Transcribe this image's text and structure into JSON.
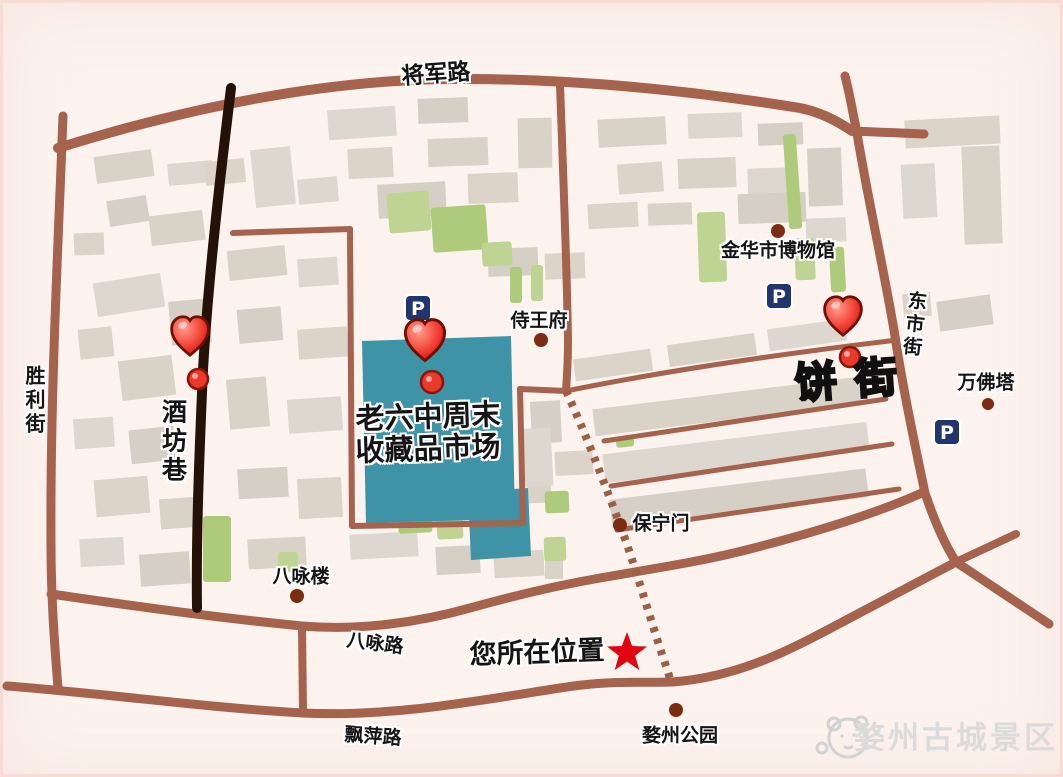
{
  "map": {
    "colors": {
      "background": "#fcf3ef",
      "road": "#a5624c",
      "road_dark": "#241208",
      "dashed_road": "#9c5f45",
      "market_teal": "#3e93a6",
      "building_shades": [
        "#d9d2c6",
        "#ddd8cf",
        "#d5cfc5",
        "#dcd4c8"
      ],
      "green_shades": [
        "#aecb7c",
        "#bdd492"
      ],
      "parking_blue": "#21356f",
      "heart_red": "#e8392b",
      "star_red": "#e00611",
      "landmark_dot": "#7c2c12",
      "text": "#141414",
      "watermark_gray": "#dbdbdb"
    },
    "labels": {
      "jiangjun_road": {
        "text": "将军路",
        "x": 436,
        "y": 75,
        "size": 23,
        "rot": -4,
        "style": "halo"
      },
      "shengli_street": {
        "text": "胜利街",
        "x": 34,
        "y": 401,
        "size": 20,
        "dir": "v",
        "style": "halo"
      },
      "jiufang_lane": {
        "text": "酒坊巷",
        "x": 173,
        "y": 442,
        "size": 25,
        "dir": "v",
        "style": "halo"
      },
      "shiwang_fu": {
        "text": "侍王府",
        "x": 539,
        "y": 321,
        "size": 19,
        "style": "halo"
      },
      "jinhua_museum": {
        "text": "金华市博物馆",
        "x": 778,
        "y": 251,
        "size": 19,
        "style": "halo"
      },
      "dongshi_street": {
        "text": "东市街",
        "x": 913,
        "y": 325,
        "size": 19,
        "dir": "v",
        "rot": 6,
        "style": "halo"
      },
      "wanfo_tower": {
        "text": "万佛塔",
        "x": 986,
        "y": 383,
        "size": 19,
        "style": "halo"
      },
      "bing_street": {
        "text": "饼街",
        "x": 855,
        "y": 380,
        "size": 42,
        "rot": -4,
        "style": "outline",
        "ls": 18
      },
      "baoning_gate": {
        "text": "保宁门",
        "x": 661,
        "y": 524,
        "size": 19,
        "style": "halo"
      },
      "bayong_tower": {
        "text": "八咏楼",
        "x": 301,
        "y": 577,
        "size": 19,
        "style": "halo"
      },
      "bayong_road": {
        "text": "八咏路",
        "x": 375,
        "y": 644,
        "size": 19,
        "rot": 7,
        "style": "halo"
      },
      "piaoping_road": {
        "text": "飘萍路",
        "x": 373,
        "y": 737,
        "size": 19,
        "rot": 4,
        "style": "halo"
      },
      "your_location": {
        "text": "您所在位置",
        "x": 537,
        "y": 653,
        "size": 27,
        "rot": -2,
        "style": "halo"
      },
      "market_line1": {
        "text": "老六中周末",
        "x": 428,
        "y": 417,
        "size": 29,
        "rot": -2,
        "style": "halo"
      },
      "market_line2": {
        "text": "收藏品市场",
        "x": 428,
        "y": 449,
        "size": 29,
        "rot": -2,
        "style": "halo"
      },
      "wuzhou_park": {
        "text": "婺州公园",
        "x": 680,
        "y": 736,
        "size": 19,
        "style": "halo"
      },
      "watermark": {
        "text": "婺州古城景区",
        "x": 956,
        "y": 739,
        "size": 31,
        "style": "watermark"
      }
    },
    "parking_label": "P",
    "roads": [
      {
        "id": "jiangjun-road",
        "d": "M 58,148 C 200,104 330,80 450,79 C 580,78 700,92 800,108 C 820,112 836,120 852,131",
        "w": 10
      },
      {
        "id": "jiangjun-road-stub",
        "d": "M 852,131 L 924,134",
        "w": 9
      },
      {
        "id": "dongshi-street",
        "d": "M 845,76 C 850,95 853,114 857,133 C 868,200 882,260 894,330 C 903,390 916,450 925,493 C 934,520 944,543 956,562",
        "w": 9
      },
      {
        "id": "southeast-branch",
        "d": "M 956,562 L 1049,624",
        "w": 9
      },
      {
        "id": "northeast-branch",
        "d": "M 956,562 C 975,553 995,544 1016,534",
        "w": 8
      },
      {
        "id": "shengli-street",
        "d": "M 63,116 C 58,250 50,400 51,545 C 51,600 55,650 58,688",
        "w": 9
      },
      {
        "id": "bayong-road",
        "d": "M 51,594 C 140,607 220,618 302,626 C 360,631 420,622 470,608 C 520,594 560,585 600,578 C 650,569 700,562 750,549 C 820,531 880,512 924,492",
        "w": 9
      },
      {
        "id": "piaoping-road",
        "d": "M 7,686 C 110,694 210,708 303,713 C 390,717 470,702 560,688 C 610,680 640,683 672,682 C 740,677 790,650 850,618 C 890,597 925,578 956,562",
        "w": 9
      },
      {
        "id": "cross-connector",
        "d": "M 302,626 L 303,713",
        "w": 8
      },
      {
        "id": "mid-vertical-road",
        "d": "M 560,84 C 563,170 567,270 568,340 C 568,360 567,377 566,391",
        "w": 8
      }
    ],
    "thin_roads": [
      {
        "id": "block-street-1",
        "d": "M 566,391 C 660,372 780,354 897,340",
        "w": 5
      },
      {
        "id": "block-street-2",
        "d": "M 604,441 L 886,399",
        "w": 5
      },
      {
        "id": "block-street-3",
        "d": "M 611,486 L 892,444",
        "w": 5
      },
      {
        "id": "block-street-4",
        "d": "M 617,530 L 899,489",
        "w": 5
      },
      {
        "id": "market-outline-top",
        "d": "M 233,233 L 350,229",
        "w": 6
      },
      {
        "id": "market-outline-left",
        "d": "M 350,229 L 352,526",
        "w": 6
      },
      {
        "id": "market-outline-bottom",
        "d": "M 352,526 L 523,523",
        "w": 6
      },
      {
        "id": "market-outline-right",
        "d": "M 523,523 L 520,389",
        "w": 6
      },
      {
        "id": "market-outline-link",
        "d": "M 520,389 L 566,391",
        "w": 6
      }
    ],
    "black_road": {
      "id": "jiufang-lane-road",
      "d": "M 231,88 C 221,170 208,280 203,370 C 199,460 196,540 197,608",
      "w": 10
    },
    "dashed_road": {
      "id": "pedestrian-street",
      "d": "M 566,391 C 585,432 602,477 620,525 C 634,562 652,625 664,660 C 668,672 670,678 671,684",
      "w": 8,
      "dash": "5 7"
    },
    "teal_blocks": [
      {
        "points": "362,341 511,336 515,519 366,523"
      },
      {
        "points": "468,492 528,488 531,556 471,560"
      }
    ],
    "greens": [
      [
        203,
        516,
        28,
        66,
        0
      ],
      [
        388,
        192,
        42,
        40,
        -5
      ],
      [
        432,
        206,
        55,
        45,
        -4
      ],
      [
        482,
        242,
        30,
        24,
        -3
      ],
      [
        398,
        509,
        34,
        24,
        -3
      ],
      [
        437,
        519,
        26,
        20,
        -3
      ],
      [
        545,
        491,
        24,
        22,
        -2
      ],
      [
        544,
        537,
        22,
        24,
        -2
      ],
      [
        616,
        437,
        18,
        10,
        -6
      ],
      [
        698,
        212,
        28,
        70,
        -2
      ],
      [
        786,
        134,
        13,
        95,
        -4
      ],
      [
        795,
        238,
        20,
        42,
        -2
      ],
      [
        830,
        247,
        15,
        45,
        -3
      ],
      [
        278,
        552,
        20,
        20,
        0
      ],
      [
        510,
        267,
        12,
        36,
        0
      ],
      [
        531,
        265,
        12,
        36,
        0
      ]
    ],
    "buildings": [
      [
        95,
        153,
        58,
        27,
        -8
      ],
      [
        168,
        162,
        45,
        22,
        -5
      ],
      [
        108,
        198,
        40,
        26,
        -9
      ],
      [
        74,
        233,
        30,
        22,
        -2
      ],
      [
        150,
        213,
        54,
        30,
        -7
      ],
      [
        95,
        278,
        68,
        34,
        -9
      ],
      [
        170,
        300,
        40,
        44,
        -5
      ],
      [
        79,
        328,
        34,
        30,
        -6
      ],
      [
        120,
        358,
        54,
        40,
        -7
      ],
      [
        74,
        418,
        40,
        30,
        -4
      ],
      [
        130,
        428,
        45,
        34,
        -6
      ],
      [
        95,
        478,
        54,
        37,
        -5
      ],
      [
        160,
        498,
        40,
        30,
        -4
      ],
      [
        80,
        538,
        44,
        28,
        -3
      ],
      [
        140,
        553,
        50,
        32,
        -4
      ],
      [
        205,
        160,
        40,
        24,
        -6
      ],
      [
        228,
        248,
        58,
        30,
        -6
      ],
      [
        298,
        258,
        40,
        28,
        -4
      ],
      [
        238,
        308,
        44,
        34,
        -5
      ],
      [
        298,
        328,
        50,
        30,
        -4
      ],
      [
        228,
        378,
        40,
        50,
        -5
      ],
      [
        288,
        398,
        54,
        34,
        -4
      ],
      [
        238,
        468,
        50,
        30,
        -3
      ],
      [
        298,
        478,
        44,
        40,
        -3
      ],
      [
        248,
        538,
        58,
        30,
        -3
      ],
      [
        328,
        108,
        68,
        30,
        -4
      ],
      [
        418,
        98,
        50,
        25,
        -2
      ],
      [
        348,
        148,
        45,
        30,
        -3
      ],
      [
        428,
        138,
        60,
        28,
        -2
      ],
      [
        298,
        178,
        40,
        25,
        -5
      ],
      [
        378,
        183,
        68,
        34,
        -3
      ],
      [
        468,
        173,
        50,
        30,
        -2
      ],
      [
        518,
        118,
        34,
        50,
        -1
      ],
      [
        253,
        148,
        40,
        58,
        -6
      ],
      [
        488,
        248,
        50,
        28,
        -2
      ],
      [
        545,
        253,
        40,
        26,
        -2
      ],
      [
        598,
        118,
        68,
        28,
        -3
      ],
      [
        688,
        113,
        54,
        25,
        -2
      ],
      [
        758,
        123,
        45,
        22,
        -2
      ],
      [
        618,
        163,
        45,
        30,
        -4
      ],
      [
        678,
        158,
        58,
        30,
        -2
      ],
      [
        748,
        168,
        40,
        44,
        -2
      ],
      [
        808,
        148,
        34,
        58,
        -2
      ],
      [
        588,
        203,
        50,
        25,
        -3
      ],
      [
        648,
        203,
        44,
        22,
        -2
      ],
      [
        806,
        218,
        40,
        24,
        -2
      ],
      [
        738,
        193,
        68,
        30,
        -2
      ],
      [
        905,
        118,
        95,
        28,
        -3
      ],
      [
        963,
        146,
        38,
        98,
        -2
      ],
      [
        902,
        164,
        34,
        54,
        -3
      ],
      [
        938,
        298,
        54,
        30,
        -8
      ],
      [
        903,
        293,
        28,
        24,
        -5
      ],
      [
        593,
        393,
        268,
        27,
        -7
      ],
      [
        603,
        438,
        266,
        29,
        -7
      ],
      [
        610,
        484,
        258,
        29,
        -7
      ],
      [
        574,
        354,
        78,
        22,
        -8
      ],
      [
        668,
        339,
        88,
        22,
        -8
      ],
      [
        768,
        324,
        78,
        22,
        -8
      ],
      [
        531,
        401,
        30,
        42,
        -3
      ],
      [
        555,
        451,
        38,
        24,
        -3
      ],
      [
        527,
        469,
        24,
        34,
        -2
      ],
      [
        350,
        533,
        68,
        25,
        -3
      ],
      [
        436,
        546,
        44,
        28,
        -3
      ],
      [
        494,
        551,
        50,
        26,
        -3
      ],
      [
        545,
        559,
        18,
        20,
        0
      ],
      [
        524,
        428,
        28,
        58,
        -3
      ]
    ],
    "landmark_dots": [
      {
        "name": "shiwangfu-dot",
        "x": 541,
        "y": 340,
        "r": 7
      },
      {
        "name": "museum-dot",
        "x": 778,
        "y": 231,
        "r": 7
      },
      {
        "name": "wanfo-tower-dot",
        "x": 988,
        "y": 404,
        "r": 6
      },
      {
        "name": "baoning-gate-dot",
        "x": 620,
        "y": 525,
        "r": 7
      },
      {
        "name": "bayong-tower-dot",
        "x": 297,
        "y": 596,
        "r": 7
      },
      {
        "name": "wuzhou-park-dot",
        "x": 676,
        "y": 710,
        "r": 7
      }
    ],
    "pin_dots": [
      {
        "name": "jiufang-lane-pin",
        "x": 198,
        "y": 379,
        "r": 10
      },
      {
        "name": "market-pin",
        "x": 432,
        "y": 382,
        "r": 11
      },
      {
        "name": "bing-street-pin",
        "x": 850,
        "y": 357,
        "r": 10
      }
    ],
    "hearts": [
      {
        "name": "heart-marker-jiufang",
        "x": 190,
        "y": 334,
        "s": 2.3
      },
      {
        "name": "heart-marker-market",
        "x": 425,
        "y": 338,
        "s": 2.45
      },
      {
        "name": "heart-marker-bing",
        "x": 843,
        "y": 314,
        "s": 2.3
      }
    ],
    "parking_icons": [
      {
        "name": "parking-icon-market",
        "x": 418,
        "y": 308
      },
      {
        "name": "parking-icon-museum",
        "x": 779,
        "y": 296
      },
      {
        "name": "parking-icon-east",
        "x": 947,
        "y": 432
      }
    ],
    "star": {
      "x": 627,
      "y": 653,
      "r": 21
    },
    "mascot": {
      "x": 848,
      "y": 738
    }
  }
}
